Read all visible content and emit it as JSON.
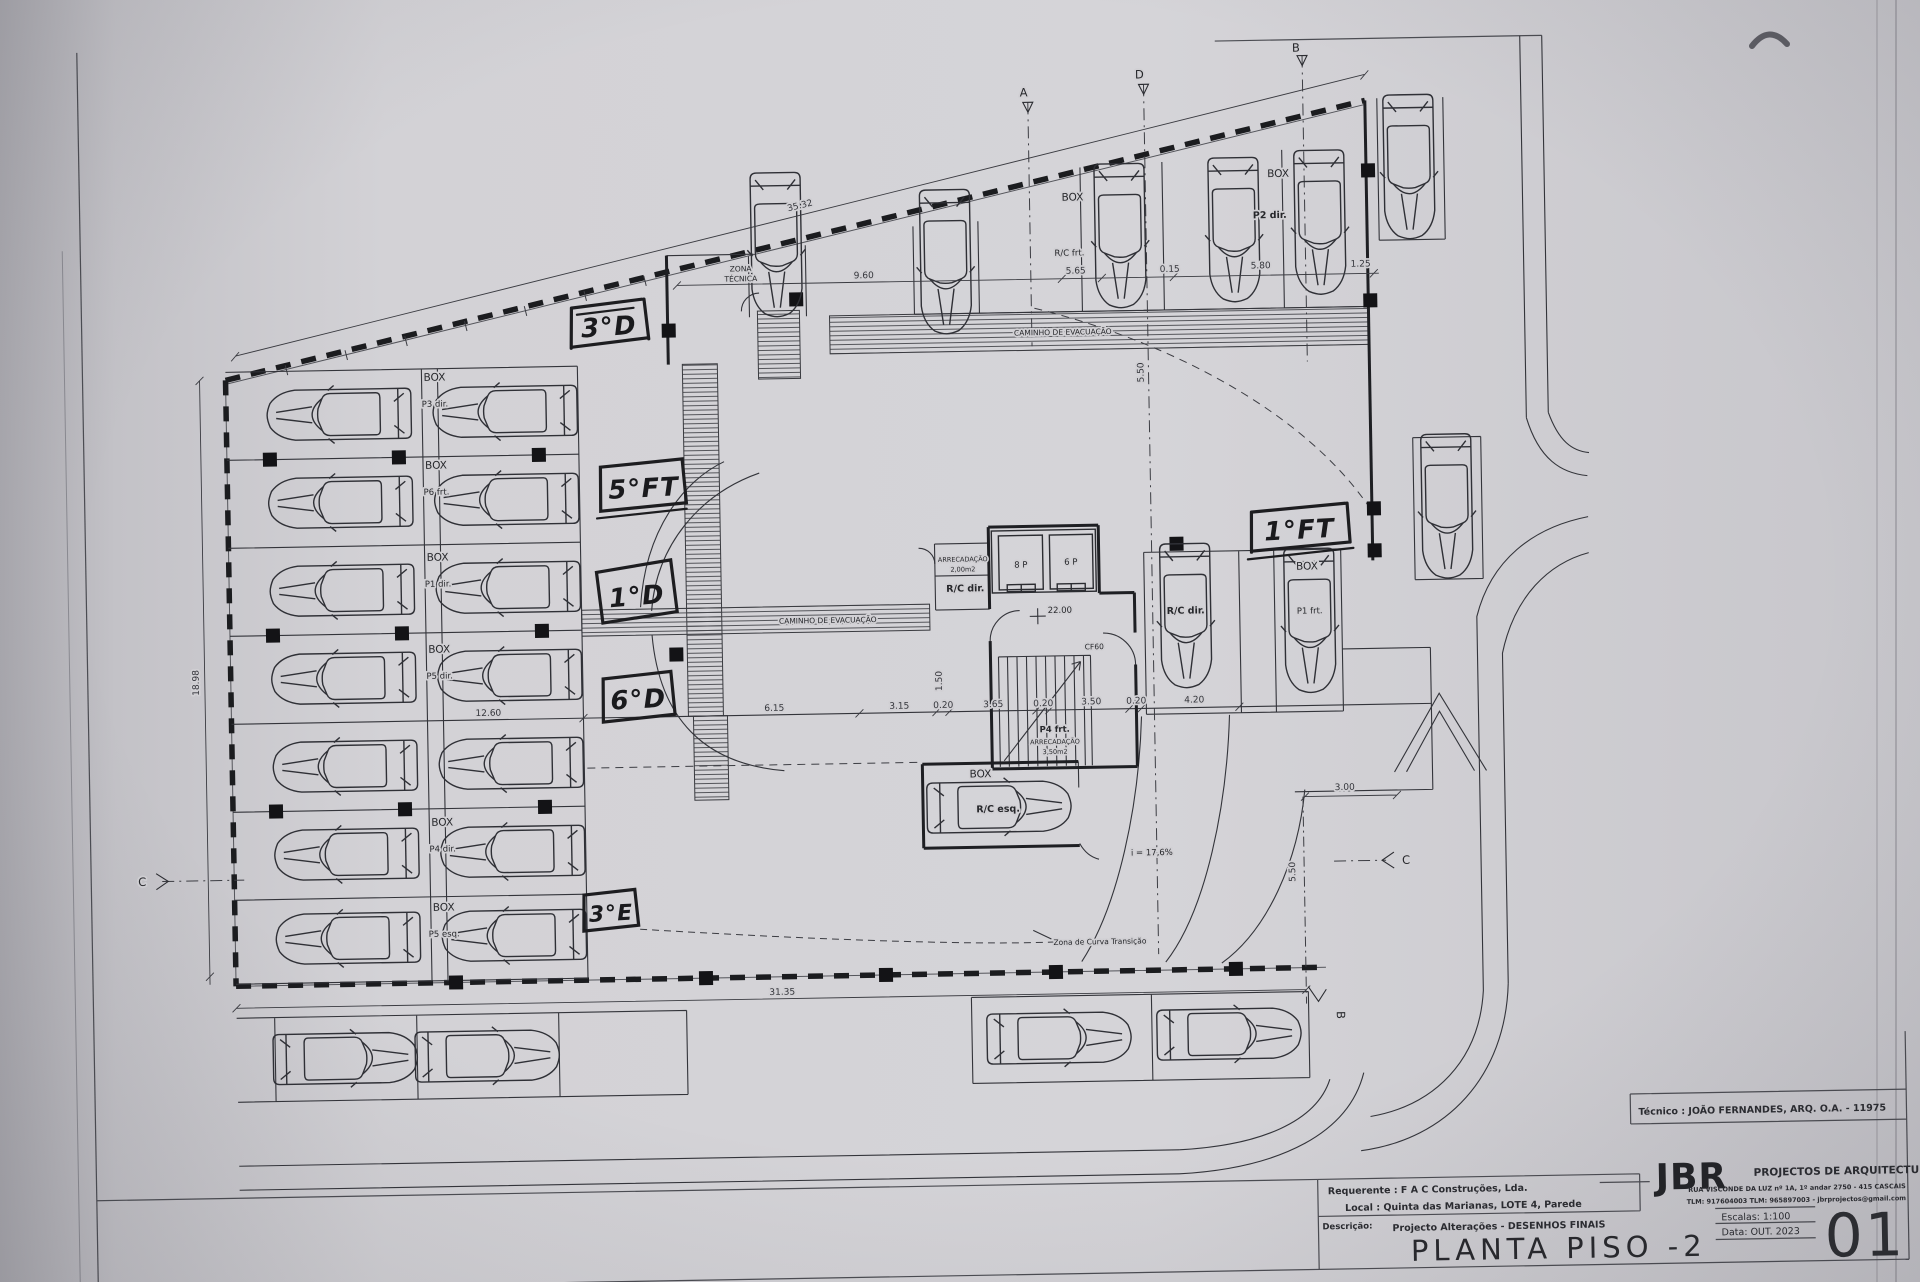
{
  "titleblock": {
    "tecnico": "Técnico : JOÃO FERNANDES, ARQ.   O.A. - 11975",
    "firm_name": "JBR",
    "firm_desc": "PROJECTOS DE ARQUITECTURA",
    "firm_address": "RUA VISCONDE DA LUZ nº 1A, 1º andar   2750 - 415   CASCAIS",
    "firm_contacts": "TLM: 917604003  TLM: 965897003 - jbrprojectos@gmail.com",
    "requerente": "Requerente : F A C  Construções, Lda.",
    "local": "Local : Quinta das Marianas, LOTE 4, Parede",
    "descricao_label": "Descrição:",
    "descricao_value": "Projecto Alterações - DESENHOS FINAIS",
    "title": "PLANTA PISO -2",
    "escala": "Escalas: 1:100",
    "data": "Data: OUT. 2023",
    "sheet": "01"
  },
  "handwritten": {
    "h3d": "3°D",
    "h5ft": "5°FT",
    "h1d": "1°D",
    "h6d": "6°D",
    "h3e": "3°E",
    "h1ft": "1°FT"
  },
  "labels": {
    "zona1": "ZONA",
    "zona2": "TÉCNICA",
    "evac": "CAMINHO DE EVACUAÇÃO",
    "box": "BOX",
    "p3dir": "P3 dir.",
    "p6frt": "P6 frt.",
    "p1dir": "P1 dir.",
    "p5dir": "P5 dir.",
    "p4dir": "P4 dir.",
    "p5esq": "P5 esq.",
    "rcfrt": "R/C frt.",
    "p2dir": "P2 dir.",
    "rcdir": "R/C dir.",
    "p1frt": "P1 frt.",
    "rcesq": "R/C esq.",
    "arrec": "ARRECADAÇÃO",
    "area200": "2,00m2",
    "area350": "3,50m2",
    "lift8": "8 P",
    "lift6": "6 P",
    "level": "22.00",
    "cf60": "CF60",
    "p4frt": "P4 frt.",
    "slope": "i = 17,6%",
    "curva": "Zona de Curva Transição"
  },
  "dims": {
    "d3532": "35.32",
    "d960": "9.60",
    "d565": "5.65",
    "d015": "0.15",
    "d580": "5.80",
    "d125": "1.25",
    "d1898": "18.98",
    "d3135": "31.35",
    "d1260": "12.60",
    "d615": "6.15",
    "d315": "3.15",
    "d365": "3.65",
    "d350": "3.50",
    "d420": "4.20",
    "d020": "0.20",
    "d300": "3.00",
    "d550": "5.50",
    "d150": "1.50"
  },
  "markers": {
    "a": "A",
    "b": "B",
    "c": "C",
    "d": "D"
  }
}
